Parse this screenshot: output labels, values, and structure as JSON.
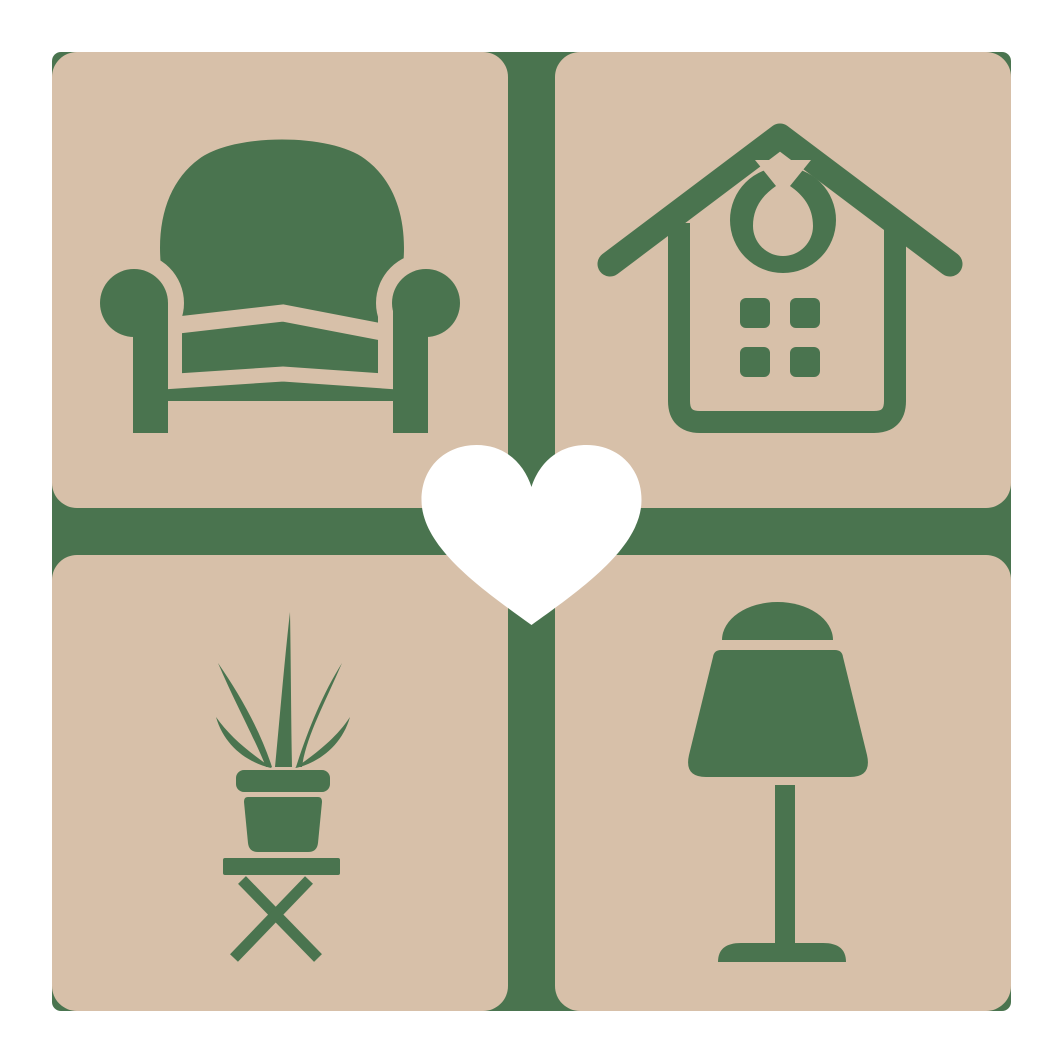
{
  "logo": {
    "name": "home-and-furniture-grid-logo",
    "colors": {
      "page_background": "#ffffff",
      "tile_tan": "#d7c0a9",
      "icon_green": "#4a744f",
      "gap_green": "#4a744f",
      "heart_white": "#ffffff"
    },
    "tiles": [
      {
        "position": "top-left",
        "icon": "armchair-icon"
      },
      {
        "position": "top-right",
        "icon": "house-icon"
      },
      {
        "position": "bottom-left",
        "icon": "potted-plant-icon"
      },
      {
        "position": "bottom-right",
        "icon": "table-lamp-icon"
      }
    ],
    "center_overlay": {
      "icon": "heart-icon"
    }
  }
}
